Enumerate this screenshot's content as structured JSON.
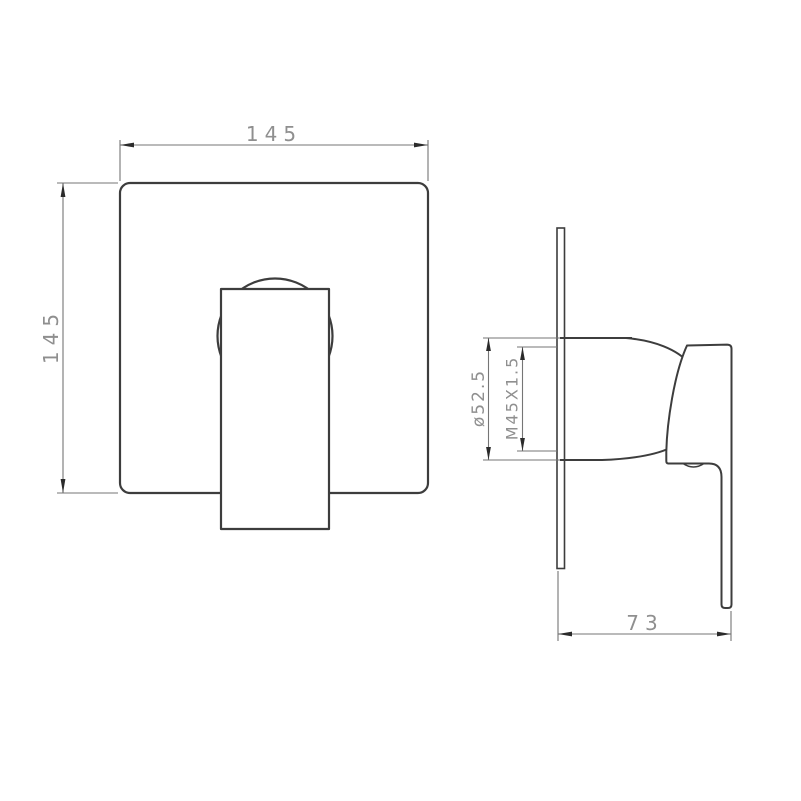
{
  "front_view": {
    "width_label": "145",
    "height_label": "145"
  },
  "side_view": {
    "diameter_label": "ø52.5",
    "thread_label": "M45X1.5",
    "depth_label": "73"
  },
  "colors": {
    "outline": "#3d3d3d",
    "dimension_line": "#757575",
    "label_text": "#8f8f8f",
    "arrow": "#2b2b2b",
    "background": "#ffffff"
  }
}
